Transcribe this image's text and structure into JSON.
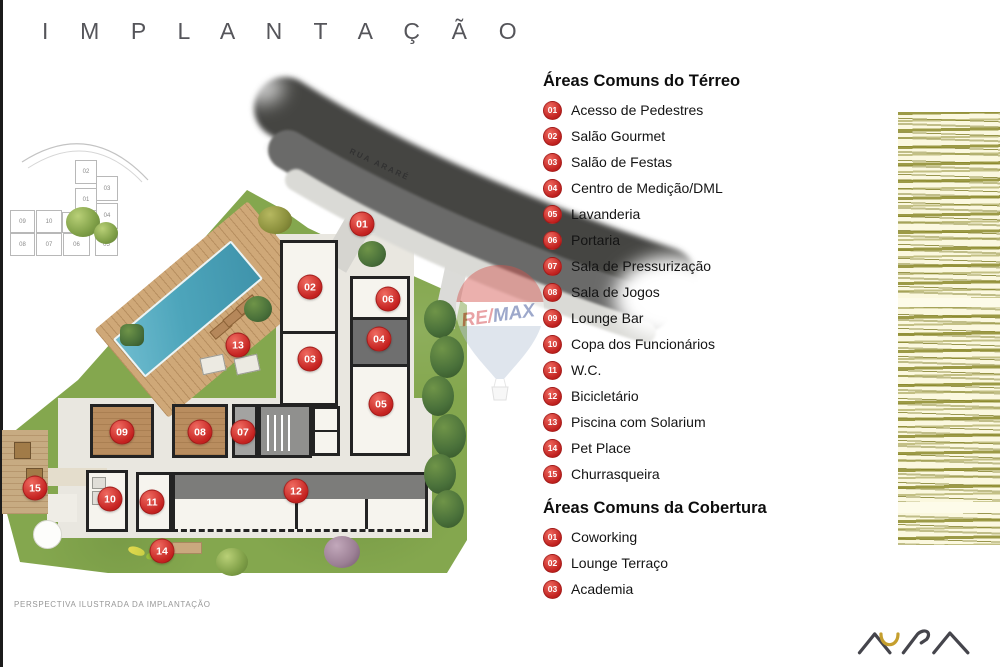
{
  "title": "I M P L A N T A Ç Ã O",
  "caption": "PERSPECTIVA ILUSTRADA DA IMPLANTAÇÃO",
  "road": {
    "label": "RUA ARARÉ"
  },
  "watermark": {
    "re": "RE",
    "slash": "/",
    "max": "MAX"
  },
  "logo": {
    "name": "AURA"
  },
  "colors": {
    "marker_red": "#c4211f",
    "lawn_green": "#84a74e",
    "pool_teal": "#4da5bb",
    "deck_tan": "#cfa878",
    "road_gray": "#5f5f5d",
    "strip_olive": "#8b892b"
  },
  "keyplan": {
    "cells": [
      {
        "n": "02",
        "x": 75,
        "y": 160,
        "w": 20,
        "h": 22
      },
      {
        "n": "03",
        "x": 96,
        "y": 176,
        "w": 20,
        "h": 23
      },
      {
        "n": "01",
        "x": 75,
        "y": 188,
        "w": 20,
        "h": 21
      },
      {
        "n": "04",
        "x": 96,
        "y": 203,
        "w": 20,
        "h": 24
      },
      {
        "n": "09",
        "x": 10,
        "y": 210,
        "w": 23,
        "h": 21
      },
      {
        "n": "10",
        "x": 36,
        "y": 210,
        "w": 24,
        "h": 21
      },
      {
        "n": "",
        "x": 62,
        "y": 212,
        "w": 13,
        "h": 19
      },
      {
        "n": "08",
        "x": 10,
        "y": 233,
        "w": 23,
        "h": 21
      },
      {
        "n": "07",
        "x": 36,
        "y": 233,
        "w": 24,
        "h": 21
      },
      {
        "n": "06",
        "x": 63,
        "y": 233,
        "w": 25,
        "h": 21
      },
      {
        "n": "05",
        "x": 95,
        "y": 233,
        "w": 21,
        "h": 21
      }
    ]
  },
  "plan": {
    "markers": [
      {
        "num": "01",
        "x": 362,
        "y": 224
      },
      {
        "num": "02",
        "x": 310,
        "y": 287
      },
      {
        "num": "03",
        "x": 310,
        "y": 359
      },
      {
        "num": "04",
        "x": 379,
        "y": 339
      },
      {
        "num": "05",
        "x": 381,
        "y": 404
      },
      {
        "num": "06",
        "x": 388,
        "y": 299
      },
      {
        "num": "07",
        "x": 243,
        "y": 432
      },
      {
        "num": "08",
        "x": 200,
        "y": 432
      },
      {
        "num": "09",
        "x": 122,
        "y": 432
      },
      {
        "num": "10",
        "x": 110,
        "y": 499
      },
      {
        "num": "11",
        "x": 152,
        "y": 502
      },
      {
        "num": "12",
        "x": 296,
        "y": 491
      },
      {
        "num": "13",
        "x": 238,
        "y": 345
      },
      {
        "num": "14",
        "x": 162,
        "y": 551
      },
      {
        "num": "15",
        "x": 35,
        "y": 488
      }
    ]
  },
  "legend": {
    "sections": [
      {
        "heading": "Áreas Comuns do Térreo",
        "items": [
          {
            "num": "01",
            "label": "Acesso de Pedestres"
          },
          {
            "num": "02",
            "label": "Salão Gourmet"
          },
          {
            "num": "03",
            "label": "Salão de Festas"
          },
          {
            "num": "04",
            "label": "Centro de Medição/DML"
          },
          {
            "num": "05",
            "label": "Lavanderia"
          },
          {
            "num": "06",
            "label": "Portaria"
          },
          {
            "num": "07",
            "label": "Sala de Pressurização"
          },
          {
            "num": "08",
            "label": "Sala de Jogos"
          },
          {
            "num": "09",
            "label": "Lounge Bar"
          },
          {
            "num": "10",
            "label": "Copa dos Funcionários"
          },
          {
            "num": "11",
            "label": "W.C."
          },
          {
            "num": "12",
            "label": "Bicicletário"
          },
          {
            "num": "13",
            "label": "Piscina com Solarium"
          },
          {
            "num": "14",
            "label": "Pet Place"
          },
          {
            "num": "15",
            "label": "Churrasqueira"
          }
        ]
      },
      {
        "heading": "Áreas Comuns da Cobertura",
        "items": [
          {
            "num": "01",
            "label": "Coworking"
          },
          {
            "num": "02",
            "label": "Lounge Terraço"
          },
          {
            "num": "03",
            "label": "Academia"
          }
        ]
      }
    ]
  }
}
